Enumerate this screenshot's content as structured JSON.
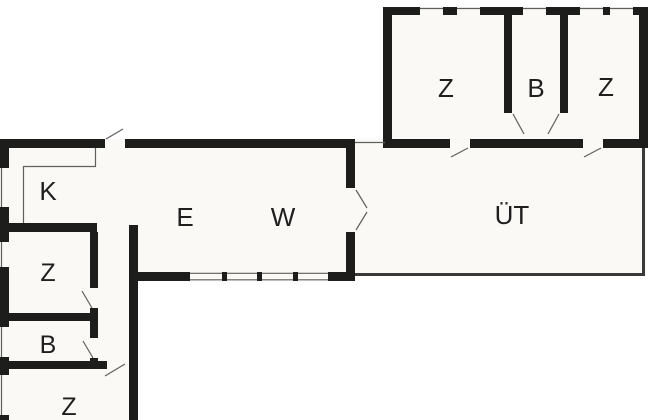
{
  "plan": {
    "type": "floor-plan",
    "rooms": [
      {
        "id": "k-west",
        "label": "K"
      },
      {
        "id": "e-main",
        "label": "E"
      },
      {
        "id": "w-main",
        "label": "W"
      },
      {
        "id": "z-west-upper",
        "label": "Z"
      },
      {
        "id": "b-west",
        "label": "B"
      },
      {
        "id": "z-west-lower",
        "label": "Z"
      },
      {
        "id": "z-north-left",
        "label": "Z"
      },
      {
        "id": "b-north",
        "label": "B"
      },
      {
        "id": "z-north-right",
        "label": "Z"
      },
      {
        "id": "ut-terrace",
        "label": "ÜT"
      }
    ]
  },
  "colors": {
    "wall": "#1d1d1b",
    "floor": "#faf9f5",
    "outside": "#ffffff",
    "terrace_line": "#3a3a3a",
    "thin_line": "#5f5f5d",
    "label": "#1f1f1f"
  }
}
